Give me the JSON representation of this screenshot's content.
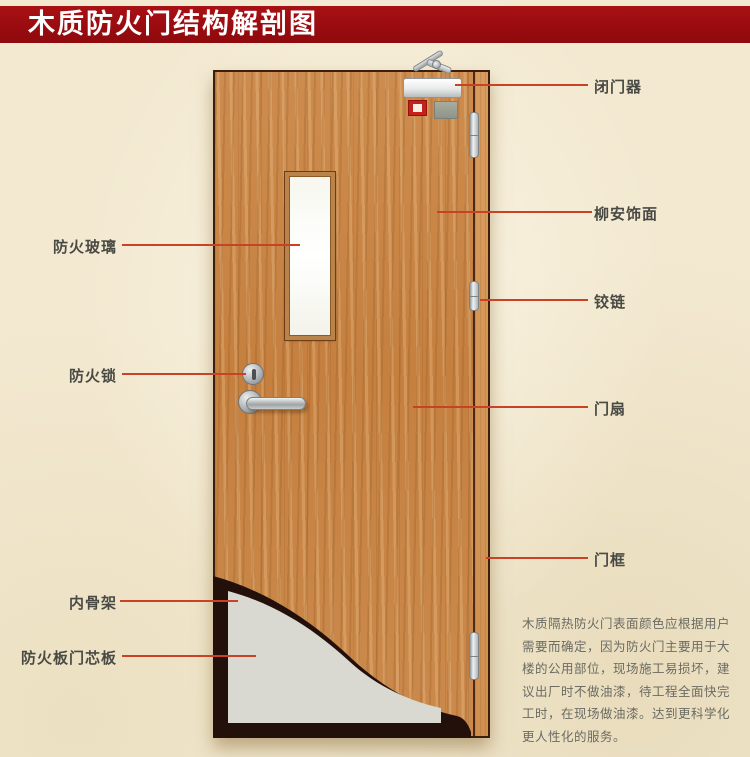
{
  "header": {
    "title": "木质防火门结构解剖图"
  },
  "labels": {
    "left": [
      {
        "text": "防火玻璃"
      },
      {
        "text": "防火锁"
      },
      {
        "text": "内骨架"
      },
      {
        "text": "防火板门芯板"
      }
    ],
    "right": [
      {
        "text": "闭门器"
      },
      {
        "text": "柳安饰面"
      },
      {
        "text": "铰链"
      },
      {
        "text": "门扇"
      },
      {
        "text": "门框"
      }
    ]
  },
  "description": {
    "lines": [
      "木质隔热防火门表面颜色应根据用户",
      "需要而确定，因为防火门主要用于大",
      "楼的公用部位，现场施工易损坏，建",
      "议出厂时不做油漆，待工程全面快完",
      "工时，在现场做油漆。达到更科学化",
      "更人性化的服务。"
    ]
  },
  "colors": {
    "banner": "#990b0f",
    "background": "#f3e9d1",
    "leader_line": "#c84226",
    "door_wood": "#c9854a",
    "frame_wood": "#d3975b",
    "skeleton_dark": "#24100a",
    "core_panel": "#d9d9d1",
    "label_text": "#4a4a45"
  }
}
